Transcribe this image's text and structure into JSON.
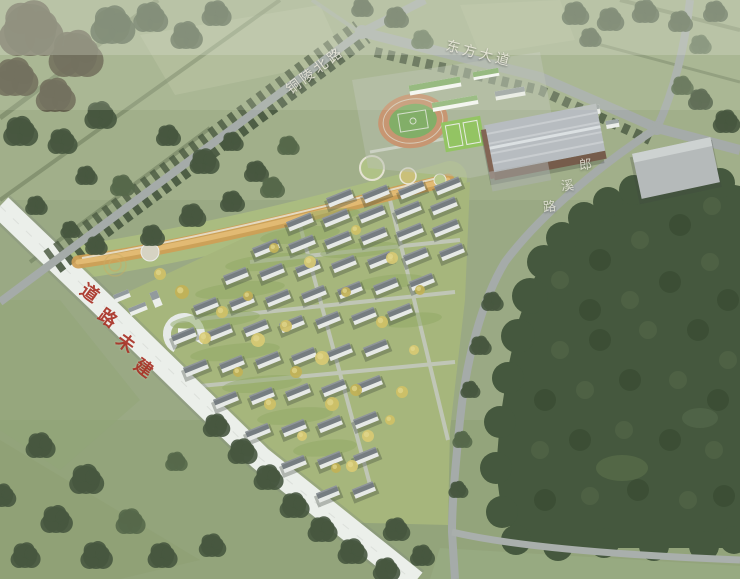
{
  "meta": {
    "description": "Aerial bird's-eye architectural rendering of a planned residential community with linear park, school campus with running track, warehouse building and surrounding roads and forest"
  },
  "labels": {
    "road_top_left": "铜陵北路",
    "road_top_right": "东方大道",
    "road_right": "郎溪路",
    "unbuilt_road": "道路未建"
  },
  "colors": {
    "field": "#96a57f",
    "field_light": "#b6c19e",
    "forest": "#3a4e33",
    "forest_dark": "#2f4229",
    "forest_light": "#46593c",
    "road": "#a2a8a8",
    "unbuilt_road": "#eef1ee",
    "unbuilt_label": "#a93226",
    "road_label": "#eceade",
    "building_wall": "#e9ebea",
    "building_roof": "#6f767c",
    "park_band": "#cf9a4c",
    "track": "#c7916c",
    "pitch": "#7cab61",
    "warehouse_roof": "#b6bac0",
    "warehouse_wall": "#6f5242",
    "autumn_tree": "#d0bf60"
  },
  "scene": {
    "building": {
      "h": 10,
      "angle": -22
    },
    "building_rows": [
      [
        340,
        198,
        36,
        -4,
        4,
        26
      ],
      [
        300,
        222,
        36,
        -4,
        5,
        26
      ],
      [
        266,
        248,
        36,
        -4,
        6,
        26
      ],
      [
        236,
        276,
        36,
        -4,
        7,
        24
      ],
      [
        206,
        306,
        36,
        -4,
        7,
        24
      ],
      [
        184,
        336,
        36,
        -4,
        7,
        24
      ],
      [
        196,
        368,
        36,
        -4,
        6,
        24
      ],
      [
        226,
        400,
        36,
        -4,
        5,
        24
      ],
      [
        258,
        432,
        36,
        -4,
        4,
        24
      ],
      [
        294,
        464,
        36,
        -4,
        3,
        24
      ],
      [
        328,
        494,
        36,
        -4,
        2,
        22
      ]
    ],
    "cluster_colors": [
      "#3c4d35",
      "#55503f",
      "#4c5f41"
    ],
    "tree_clusters": [
      [
        30,
        30,
        26,
        1
      ],
      [
        75,
        55,
        22,
        1
      ],
      [
        15,
        78,
        18,
        1
      ],
      [
        112,
        26,
        18,
        0
      ],
      [
        55,
        96,
        16,
        1
      ],
      [
        150,
        18,
        14,
        0
      ],
      [
        186,
        36,
        13,
        0
      ],
      [
        216,
        14,
        12,
        0
      ],
      [
        100,
        116,
        13,
        0
      ],
      [
        20,
        132,
        14,
        0
      ],
      [
        62,
        142,
        12,
        0
      ],
      [
        168,
        136,
        10,
        0
      ],
      [
        204,
        162,
        12,
        0
      ],
      [
        232,
        142,
        9,
        0
      ],
      [
        122,
        186,
        10,
        2
      ],
      [
        86,
        176,
        9,
        0
      ],
      [
        36,
        206,
        9,
        0
      ],
      [
        256,
        172,
        10,
        0
      ],
      [
        288,
        146,
        9,
        2
      ],
      [
        192,
        216,
        11,
        0
      ],
      [
        232,
        202,
        10,
        0
      ],
      [
        272,
        188,
        10,
        2
      ],
      [
        152,
        236,
        10,
        0
      ],
      [
        96,
        246,
        9,
        0
      ],
      [
        70,
        230,
        8,
        0
      ],
      [
        362,
        8,
        9,
        0
      ],
      [
        396,
        18,
        10,
        0
      ],
      [
        422,
        40,
        9,
        2
      ],
      [
        575,
        14,
        11,
        0
      ],
      [
        610,
        20,
        11,
        0
      ],
      [
        645,
        12,
        11,
        0
      ],
      [
        680,
        22,
        10,
        0
      ],
      [
        715,
        12,
        10,
        0
      ],
      [
        700,
        45,
        9,
        2
      ],
      [
        590,
        38,
        9,
        0
      ],
      [
        700,
        100,
        10,
        0
      ],
      [
        726,
        122,
        11,
        0
      ],
      [
        682,
        86,
        9,
        2
      ],
      [
        40,
        446,
        12,
        0
      ],
      [
        86,
        480,
        14,
        0
      ],
      [
        56,
        520,
        13,
        0
      ],
      [
        130,
        522,
        12,
        2
      ],
      [
        25,
        556,
        12,
        0
      ],
      [
        96,
        556,
        13,
        0
      ],
      [
        162,
        556,
        12,
        0
      ],
      [
        212,
        546,
        11,
        0
      ],
      [
        2,
        496,
        11,
        0
      ],
      [
        216,
        426,
        11,
        0
      ],
      [
        242,
        452,
        12,
        0
      ],
      [
        268,
        478,
        12,
        0
      ],
      [
        294,
        506,
        12,
        0
      ],
      [
        322,
        530,
        12,
        0
      ],
      [
        352,
        552,
        12,
        0
      ],
      [
        386,
        570,
        11,
        0
      ],
      [
        176,
        462,
        9,
        2
      ],
      [
        396,
        530,
        11,
        0
      ],
      [
        422,
        556,
        10,
        0
      ],
      [
        492,
        302,
        9,
        0
      ],
      [
        480,
        346,
        9,
        0
      ],
      [
        470,
        390,
        8,
        0
      ],
      [
        462,
        440,
        8,
        2
      ],
      [
        458,
        490,
        8,
        0
      ]
    ],
    "forest_edge_blobs": [
      [
        530,
        296,
        18
      ],
      [
        518,
        336,
        17
      ],
      [
        508,
        378,
        16
      ],
      [
        500,
        422,
        16
      ],
      [
        496,
        468,
        16
      ],
      [
        502,
        512,
        16
      ],
      [
        544,
        262,
        17
      ],
      [
        562,
        238,
        16
      ],
      [
        584,
        218,
        16
      ],
      [
        608,
        202,
        15
      ],
      [
        634,
        190,
        15
      ],
      [
        662,
        184,
        15
      ],
      [
        692,
        180,
        15
      ],
      [
        720,
        183,
        15
      ],
      [
        516,
        540,
        15
      ],
      [
        558,
        546,
        15
      ],
      [
        604,
        543,
        15
      ],
      [
        654,
        546,
        15
      ],
      [
        704,
        546,
        15
      ],
      [
        734,
        540,
        14
      ]
    ],
    "forest_dots": [
      [
        560,
        280,
        9
      ],
      [
        600,
        260,
        11
      ],
      [
        640,
        240,
        9
      ],
      [
        680,
        225,
        11
      ],
      [
        712,
        206,
        9
      ],
      [
        590,
        310,
        11
      ],
      [
        630,
        300,
        9
      ],
      [
        670,
        282,
        11
      ],
      [
        710,
        262,
        9
      ],
      [
        728,
        300,
        11
      ],
      [
        560,
        350,
        9
      ],
      [
        600,
        340,
        11
      ],
      [
        648,
        330,
        9
      ],
      [
        698,
        330,
        11
      ],
      [
        728,
        360,
        9
      ],
      [
        545,
        400,
        11
      ],
      [
        585,
        390,
        9
      ],
      [
        630,
        380,
        11
      ],
      [
        678,
        380,
        9
      ],
      [
        718,
        400,
        11
      ],
      [
        540,
        450,
        9
      ],
      [
        580,
        440,
        11
      ],
      [
        624,
        430,
        9
      ],
      [
        670,
        440,
        11
      ],
      [
        714,
        450,
        9
      ],
      [
        545,
        500,
        11
      ],
      [
        590,
        496,
        9
      ],
      [
        638,
        490,
        11
      ],
      [
        688,
        500,
        9
      ],
      [
        724,
        496,
        11
      ]
    ],
    "yellow_trees": [
      [
        222,
        312,
        6
      ],
      [
        258,
        340,
        7
      ],
      [
        296,
        372,
        6
      ],
      [
        332,
        404,
        7
      ],
      [
        368,
        436,
        6
      ],
      [
        248,
        296,
        5
      ],
      [
        286,
        326,
        6
      ],
      [
        322,
        358,
        7
      ],
      [
        356,
        390,
        6
      ],
      [
        390,
        420,
        5
      ],
      [
        310,
        262,
        6
      ],
      [
        346,
        292,
        5
      ],
      [
        382,
        322,
        6
      ],
      [
        414,
        350,
        5
      ],
      [
        274,
        248,
        5
      ],
      [
        356,
        230,
        5
      ],
      [
        392,
        258,
        6
      ],
      [
        420,
        290,
        5
      ],
      [
        402,
        392,
        6
      ],
      [
        352,
        466,
        6
      ],
      [
        182,
        292,
        7
      ],
      [
        160,
        274,
        6
      ],
      [
        205,
        338,
        6
      ],
      [
        238,
        372,
        5
      ],
      [
        270,
        404,
        6
      ],
      [
        302,
        436,
        5
      ],
      [
        336,
        468,
        5
      ]
    ],
    "courtyards": [
      [
        300,
        235,
        40,
        8
      ],
      [
        270,
        262,
        45,
        8
      ],
      [
        240,
        290,
        45,
        8
      ],
      [
        215,
        320,
        45,
        8
      ],
      [
        235,
        352,
        45,
        8
      ],
      [
        262,
        384,
        40,
        8
      ],
      [
        295,
        416,
        38,
        8
      ],
      [
        325,
        448,
        32,
        8
      ],
      [
        330,
        215,
        30,
        6
      ],
      [
        360,
        250,
        40,
        7
      ],
      [
        390,
        282,
        35,
        7
      ],
      [
        412,
        320,
        30,
        7
      ]
    ]
  }
}
